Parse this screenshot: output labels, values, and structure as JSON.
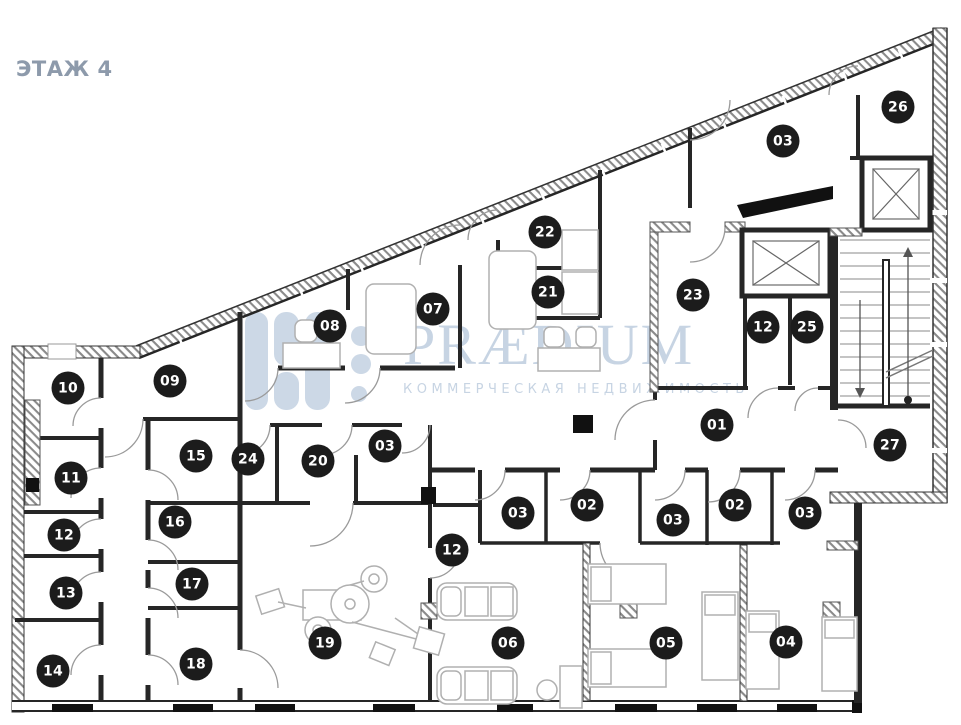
{
  "floor_label": "ЭТАЖ 4",
  "watermark": {
    "brand": "PRÆDIUM",
    "tagline": "КОММЕРЧЕСКАЯ НЕДВИЖИМОСТЬ"
  },
  "colors": {
    "accent_title": "#8d9aab",
    "marker_bg": "#1c1c1c",
    "marker_text": "#ffffff",
    "watermark_text": "#c7d4e3",
    "wall_dark": "#262626",
    "hatch_line": "#8a8a8a",
    "door_arc": "#9a9a9a",
    "furniture_line": "#b0b0b0"
  },
  "rooms": [
    {
      "number": "26",
      "x": 898,
      "y": 107
    },
    {
      "number": "03",
      "x": 783,
      "y": 141
    },
    {
      "number": "22",
      "x": 545,
      "y": 232
    },
    {
      "number": "21",
      "x": 548,
      "y": 292
    },
    {
      "number": "23",
      "x": 693,
      "y": 295
    },
    {
      "number": "07",
      "x": 433,
      "y": 309
    },
    {
      "number": "08",
      "x": 330,
      "y": 326
    },
    {
      "number": "12",
      "x": 763,
      "y": 327
    },
    {
      "number": "25",
      "x": 807,
      "y": 327
    },
    {
      "number": "09",
      "x": 170,
      "y": 381
    },
    {
      "number": "10",
      "x": 68,
      "y": 388
    },
    {
      "number": "01",
      "x": 717,
      "y": 425
    },
    {
      "number": "27",
      "x": 890,
      "y": 445
    },
    {
      "number": "03",
      "x": 385,
      "y": 446
    },
    {
      "number": "15",
      "x": 196,
      "y": 456
    },
    {
      "number": "24",
      "x": 248,
      "y": 459
    },
    {
      "number": "20",
      "x": 318,
      "y": 461
    },
    {
      "number": "11",
      "x": 71,
      "y": 478
    },
    {
      "number": "02",
      "x": 587,
      "y": 505
    },
    {
      "number": "02",
      "x": 735,
      "y": 505
    },
    {
      "number": "03",
      "x": 518,
      "y": 513
    },
    {
      "number": "03",
      "x": 805,
      "y": 513
    },
    {
      "number": "03",
      "x": 673,
      "y": 520
    },
    {
      "number": "16",
      "x": 175,
      "y": 522
    },
    {
      "number": "12",
      "x": 64,
      "y": 535
    },
    {
      "number": "12",
      "x": 452,
      "y": 550
    },
    {
      "number": "17",
      "x": 192,
      "y": 584
    },
    {
      "number": "13",
      "x": 66,
      "y": 593
    },
    {
      "number": "19",
      "x": 325,
      "y": 643
    },
    {
      "number": "06",
      "x": 508,
      "y": 643
    },
    {
      "number": "05",
      "x": 666,
      "y": 643
    },
    {
      "number": "04",
      "x": 786,
      "y": 642
    },
    {
      "number": "18",
      "x": 196,
      "y": 664
    },
    {
      "number": "14",
      "x": 53,
      "y": 671
    }
  ]
}
